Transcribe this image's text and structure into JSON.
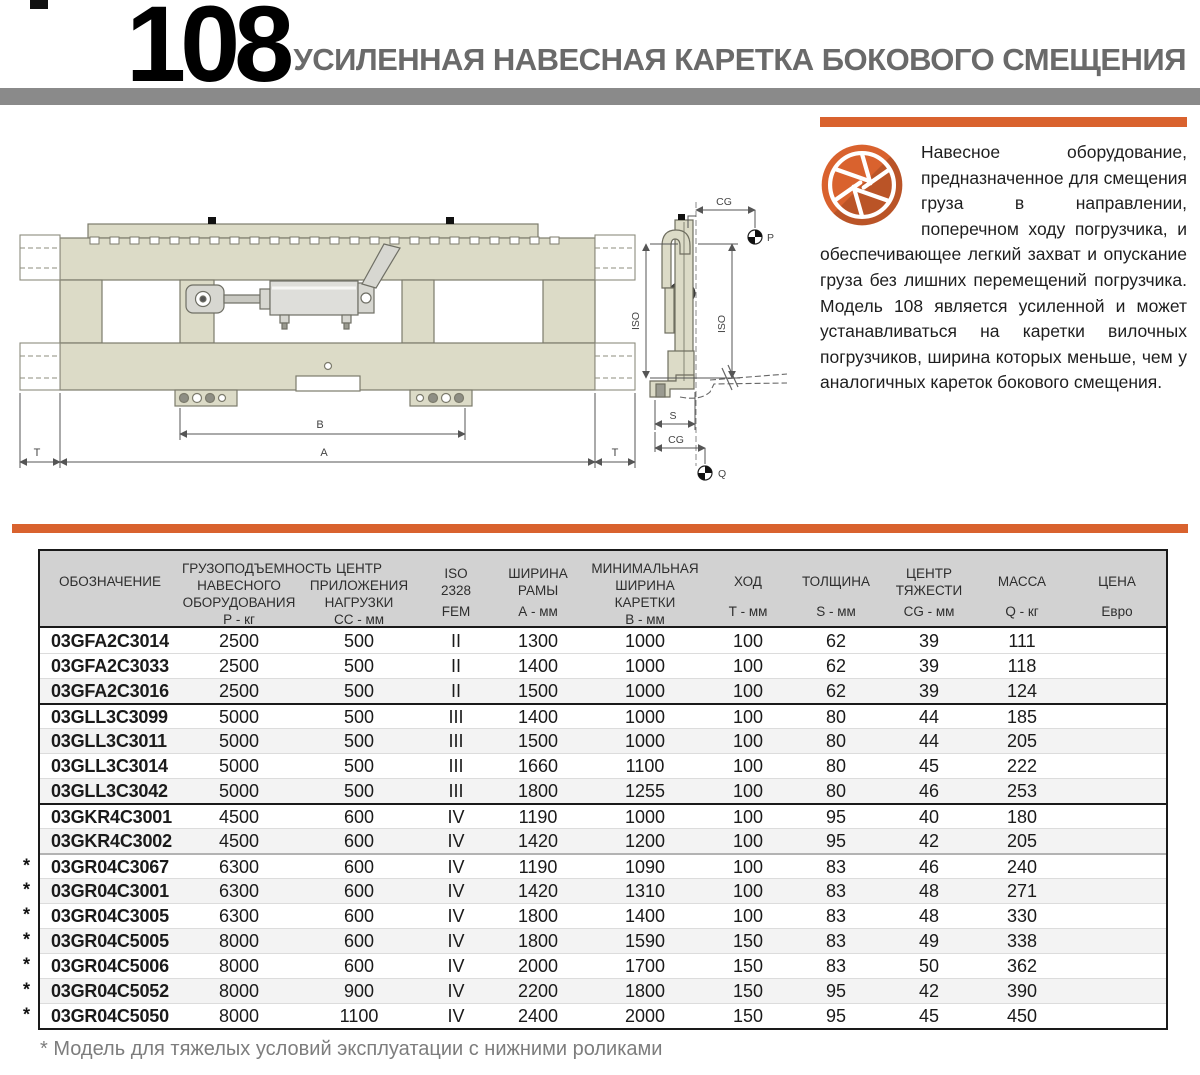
{
  "page": {
    "number": "108",
    "title": "УСИЛЕННАЯ НАВЕСНАЯ КАРЕТКА БОКОВОГО СМЕЩЕНИЯ"
  },
  "intro": {
    "text": "Навесное оборудование, предназначенное для смещения груза в направлении, поперечном ходу погрузчика, и обеспечивающее легкий захват и опускание груза без лишних перемещений погрузчика. Модель 108 является усиленной и может устанавливаться на каретки вилочных погрузчиков, ширина которых меньше, чем у аналогичных кареток бокового смещения."
  },
  "drawing": {
    "labels": {
      "dim_a": "A",
      "dim_b": "B",
      "dim_t_left": "T",
      "dim_t_right": "T",
      "iso_left": "ISO",
      "iso_right": "ISO",
      "cg_top": "CG",
      "cg_bottom": "CG",
      "dim_s": "S",
      "point_p": "P",
      "point_q": "Q"
    }
  },
  "colors": {
    "accent_orange": "#d9622e",
    "bar_gray": "#8a8a8a"
  },
  "table": {
    "headers": [
      {
        "lines": [
          "ОБОЗНАЧЕНИЕ"
        ],
        "unit": ""
      },
      {
        "lines": [
          "ГРУЗОПОДЪЕМНОСТЬ",
          "НАВЕСНОГО ОБОРУДОВАНИЯ"
        ],
        "unit": "Р - кг"
      },
      {
        "lines": [
          "ЦЕНТР ПРИЛОЖЕНИЯ",
          "НАГРУЗКИ"
        ],
        "unit": "СС - мм"
      },
      {
        "lines": [
          "ISO",
          "2328"
        ],
        "unit": "FEM"
      },
      {
        "lines": [
          "ШИРИНА",
          "РАМЫ"
        ],
        "unit": "А - мм"
      },
      {
        "lines": [
          "МИНИМАЛЬНАЯ",
          "ШИРИНА КАРЕТКИ"
        ],
        "unit": "В - мм"
      },
      {
        "lines": [
          "ХОД"
        ],
        "unit": "Т - мм"
      },
      {
        "lines": [
          "ТОЛЩИНА"
        ],
        "unit": "S - мм"
      },
      {
        "lines": [
          "ЦЕНТР",
          "ТЯЖЕСТИ"
        ],
        "unit": "CG - мм"
      },
      {
        "lines": [
          "МАССА"
        ],
        "unit": "Q - кг"
      },
      {
        "lines": [
          "ЦЕНА"
        ],
        "unit": "Евро"
      }
    ],
    "rows": [
      {
        "star": false,
        "cells": [
          "03GFA2C3014",
          "2500",
          "500",
          "II",
          "1300",
          "1000",
          "100",
          "62",
          "39",
          "111",
          ""
        ]
      },
      {
        "star": false,
        "cells": [
          "03GFA2C3033",
          "2500",
          "500",
          "II",
          "1400",
          "1000",
          "100",
          "62",
          "39",
          "118",
          ""
        ]
      },
      {
        "star": false,
        "cells": [
          "03GFA2C3016",
          "2500",
          "500",
          "II",
          "1500",
          "1000",
          "100",
          "62",
          "39",
          "124",
          ""
        ]
      },
      {
        "star": false,
        "cells": [
          "03GLL3C3099",
          "5000",
          "500",
          "III",
          "1400",
          "1000",
          "100",
          "80",
          "44",
          "185",
          ""
        ]
      },
      {
        "star": false,
        "cells": [
          "03GLL3C3011",
          "5000",
          "500",
          "III",
          "1500",
          "1000",
          "100",
          "80",
          "44",
          "205",
          ""
        ]
      },
      {
        "star": false,
        "cells": [
          "03GLL3C3014",
          "5000",
          "500",
          "III",
          "1660",
          "1100",
          "100",
          "80",
          "45",
          "222",
          ""
        ]
      },
      {
        "star": false,
        "cells": [
          "03GLL3C3042",
          "5000",
          "500",
          "III",
          "1800",
          "1255",
          "100",
          "80",
          "46",
          "253",
          ""
        ]
      },
      {
        "star": false,
        "cells": [
          "03GKR4C3001",
          "4500",
          "600",
          "IV",
          "1190",
          "1000",
          "100",
          "95",
          "40",
          "180",
          ""
        ]
      },
      {
        "star": false,
        "cells": [
          "03GKR4C3002",
          "4500",
          "600",
          "IV",
          "1420",
          "1200",
          "100",
          "95",
          "42",
          "205",
          ""
        ]
      },
      {
        "star": true,
        "cells": [
          "03GR04C3067",
          "6300",
          "600",
          "IV",
          "1190",
          "1090",
          "100",
          "83",
          "46",
          "240",
          ""
        ]
      },
      {
        "star": true,
        "cells": [
          "03GR04C3001",
          "6300",
          "600",
          "IV",
          "1420",
          "1310",
          "100",
          "83",
          "48",
          "271",
          ""
        ]
      },
      {
        "star": true,
        "cells": [
          "03GR04C3005",
          "6300",
          "600",
          "IV",
          "1800",
          "1400",
          "100",
          "83",
          "48",
          "330",
          ""
        ]
      },
      {
        "star": true,
        "cells": [
          "03GR04C5005",
          "8000",
          "600",
          "IV",
          "1800",
          "1590",
          "150",
          "83",
          "49",
          "338",
          ""
        ]
      },
      {
        "star": true,
        "cells": [
          "03GR04C5006",
          "8000",
          "600",
          "IV",
          "2000",
          "1700",
          "150",
          "83",
          "50",
          "362",
          ""
        ]
      },
      {
        "star": true,
        "cells": [
          "03GR04C5052",
          "8000",
          "900",
          "IV",
          "2200",
          "1800",
          "150",
          "95",
          "42",
          "390",
          ""
        ]
      },
      {
        "star": true,
        "cells": [
          "03GR04C5050",
          "8000",
          "1100",
          "IV",
          "2400",
          "2000",
          "150",
          "95",
          "45",
          "450",
          ""
        ]
      }
    ],
    "group_breaks_strong": [
      3,
      7
    ],
    "group_breaks_light": [
      9
    ]
  },
  "footnote": {
    "marker": "*",
    "text": "Модель для тяжелых условий эксплуатации с нижними роликами"
  }
}
